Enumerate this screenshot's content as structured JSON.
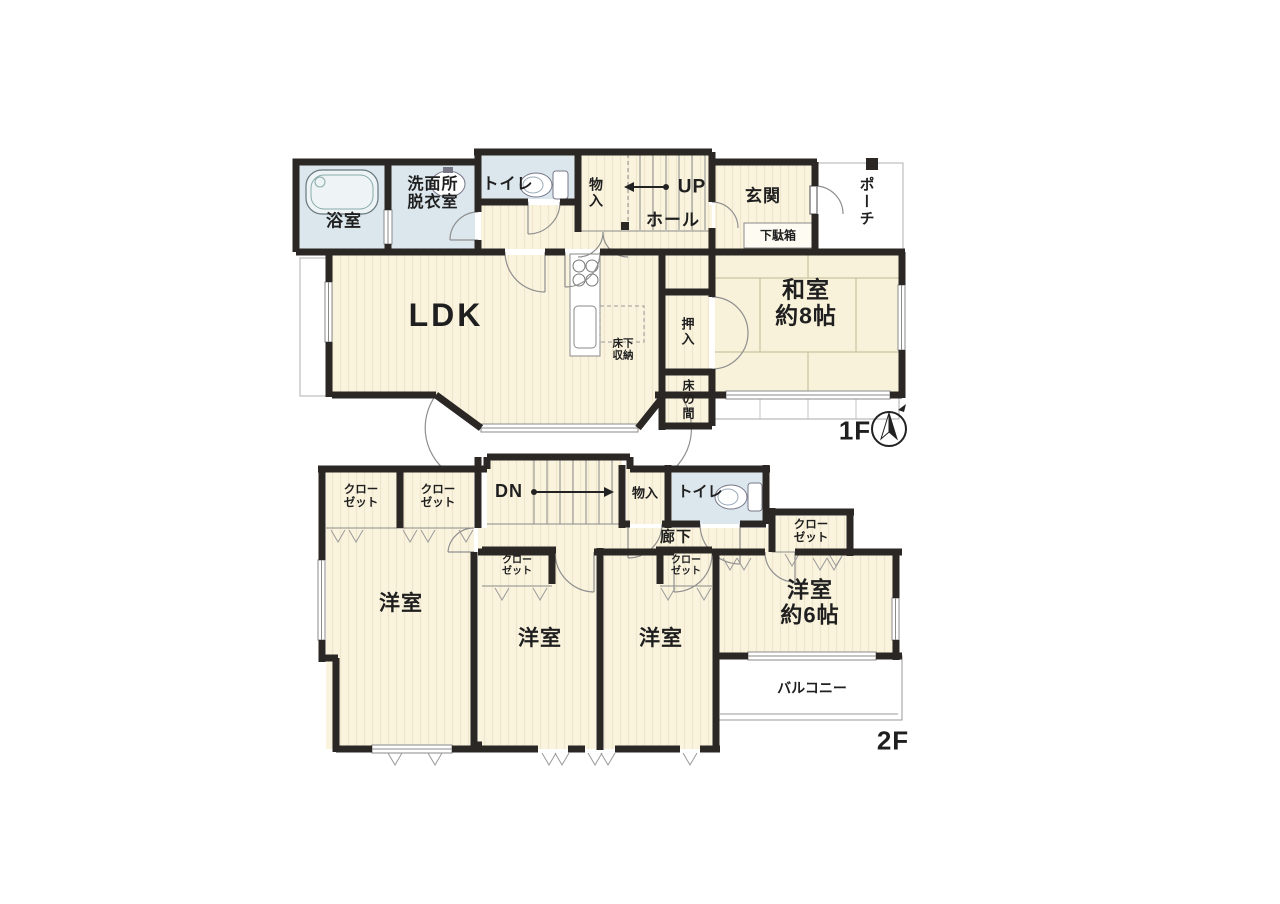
{
  "page": {
    "type": "real-estate floor plan (madori-zu)"
  },
  "colors": {
    "wall": "#2b2724",
    "wood_floor": "#faf4df",
    "tatami": "#f8f2da",
    "wet_area": "#dbe7ed",
    "thin_line": "#8a8a8a",
    "text": "#1f1f1f",
    "background": "#ffffff"
  },
  "floor1": {
    "label": "1F",
    "bathroom": "浴室",
    "washroom": "洗面所\n脱衣室",
    "toilet": "トイレ",
    "storage": "物入",
    "stairs_up": "UP",
    "hall": "ホール",
    "entrance": "玄関",
    "shoe_cabinet": "下駄箱",
    "porch": "ポーチ",
    "ldk": "LDK",
    "underfloor_storage": "床下\n収納",
    "oshiire": "押入",
    "tokonoma": "床の間",
    "japanese_room": "和室\n約8帖"
  },
  "floor2": {
    "label": "2F",
    "closet_left_1": "クロー\nゼット",
    "closet_left_2": "クロー\nゼット",
    "stairs_down": "DN",
    "storage": "物入",
    "toilet": "トイレ",
    "corridor": "廊下",
    "closet_right": "クロー\nゼット",
    "closet_mid_1": "クロー\nゼット",
    "closet_mid_2": "クロー\nゼット",
    "western_room_large": "洋室",
    "western_room_mid_1": "洋室",
    "western_room_mid_2": "洋室",
    "western_room_6": "洋室\n約6帖",
    "balcony": "バルコニー"
  }
}
